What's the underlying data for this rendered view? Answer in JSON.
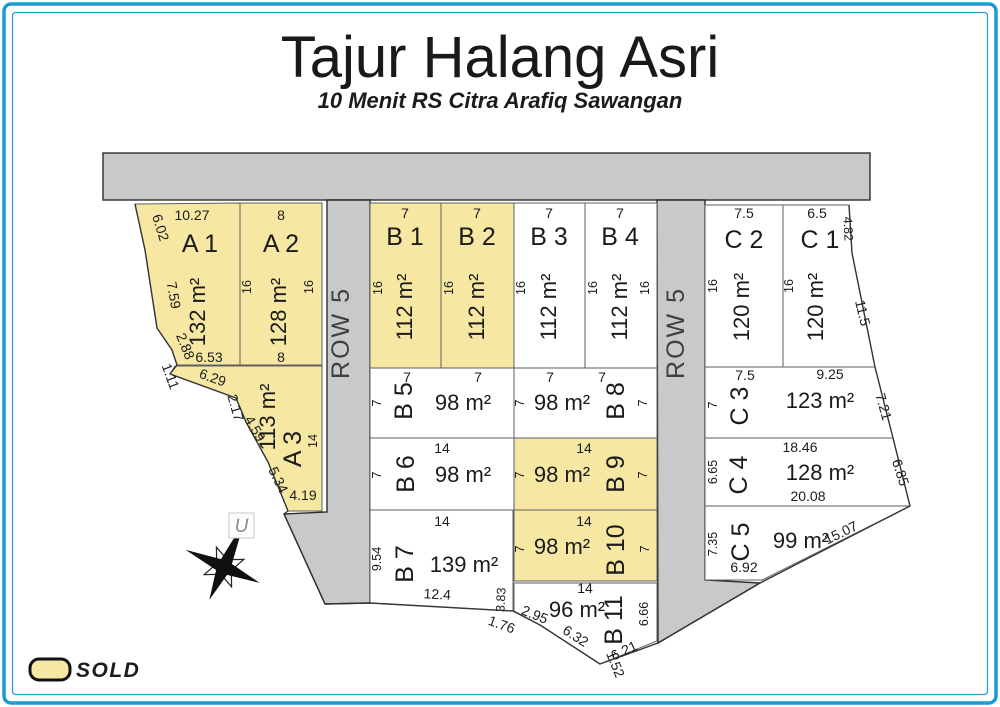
{
  "title": "Tajur Halang Asri",
  "subtitle": "10 Menit RS Citra Arafiq Sawangan",
  "legend": {
    "sold_label": "SOLD"
  },
  "compass": {
    "north_label": "U"
  },
  "roads": {
    "left_label": "ROW 5",
    "right_label": "ROW 5"
  },
  "colors": {
    "sold": "#F6E7A3",
    "road": "#C9C9C9",
    "frame": "#189BD7",
    "frame_inner": "#2E9FD2",
    "red": "#C01E2E"
  },
  "plots": {
    "A1": {
      "name": "A 1",
      "area": "132 m²",
      "sold": true,
      "dims": {
        "top": "10.27",
        "left_upper": "6.02",
        "left_mid": "7.59",
        "left_lower": "2.88",
        "bottom": "6.53"
      }
    },
    "A2": {
      "name": "A 2",
      "area": "128 m²",
      "sold": true,
      "dims": {
        "top": "8",
        "left": "16",
        "right": "16",
        "bottom": "8"
      }
    },
    "A3": {
      "name": "A 3",
      "area": "113 m²",
      "sold": true,
      "dims": {
        "outer_1": "1.11",
        "edge_1": "6.29",
        "edge_2": "2.17",
        "edge_3": "4.59",
        "edge_4": "5.34",
        "right": "14",
        "bottom": "4.19"
      }
    },
    "B1": {
      "name": "B 1",
      "area": "112 m²",
      "sold": true,
      "dims": {
        "top": "7",
        "left": "16"
      }
    },
    "B2": {
      "name": "B 2",
      "area": "112 m²",
      "sold": true,
      "dims": {
        "top": "7",
        "left": "16"
      }
    },
    "B3": {
      "name": "B 3",
      "area": "112 m²",
      "sold": false,
      "dims": {
        "top": "7",
        "left": "16"
      }
    },
    "B4": {
      "name": "B 4",
      "area": "112 m²",
      "sold": false,
      "dims": {
        "top": "7",
        "left": "16",
        "right": "16"
      }
    },
    "B5": {
      "name": "B 5",
      "area": "98 m²",
      "sold": false,
      "dims": {
        "top_1": "7",
        "top_2": "7",
        "left": "7"
      }
    },
    "B8": {
      "name": "B 8",
      "area": "98 m²",
      "sold": false,
      "dims": {
        "top_1": "7",
        "top_2": "7",
        "left": "7",
        "right": "7"
      }
    },
    "B6": {
      "name": "B 6",
      "area": "98 m²",
      "sold": false,
      "dims": {
        "top": "14",
        "left": "7"
      }
    },
    "B9": {
      "name": "B 9",
      "area": "98 m²",
      "sold": true,
      "dims": {
        "top": "14",
        "left": "7",
        "right": "7"
      }
    },
    "B7": {
      "name": "B 7",
      "area": "139 m²",
      "sold": false,
      "dims": {
        "top": "14",
        "left": "9.54",
        "bottom": "12.4",
        "right_lower": "3.83",
        "outer": "1.76"
      }
    },
    "B10": {
      "name": "B 10",
      "area": "98 m²",
      "sold": true,
      "dims": {
        "top": "14",
        "left": "7",
        "right": "7"
      }
    },
    "B11": {
      "name": "B 11",
      "area": "96 m²",
      "sold": false,
      "dims": {
        "top": "14",
        "right": "6.66",
        "edge_1": "2.95",
        "edge_2": "6.32",
        "edge_3": "1.52",
        "edge_4": "6.21"
      }
    },
    "C2": {
      "name": "C 2",
      "area": "120 m²",
      "sold": false,
      "dims": {
        "top": "7.5",
        "left": "16"
      }
    },
    "C1": {
      "name": "C 1",
      "area": "120 m²",
      "sold": false,
      "dims": {
        "top": "6.5",
        "left": "16",
        "right_upper": "4.82",
        "slant": "11.5"
      }
    },
    "C3": {
      "name": "C 3",
      "area": "123 m²",
      "sold": false,
      "dims": {
        "top_1": "7.5",
        "top_2": "9.25",
        "left": "7",
        "slant": "7.21"
      }
    },
    "C4": {
      "name": "C 4",
      "area": "128 m²",
      "sold": false,
      "dims": {
        "top": "18.46",
        "left": "6.65",
        "bottom": "20.08",
        "slant": "6.85"
      }
    },
    "C5": {
      "name": "C 5",
      "area": "99 m²",
      "sold": false,
      "dims": {
        "left": "7.35",
        "bottom": "6.92",
        "slant": "15.07"
      }
    }
  }
}
